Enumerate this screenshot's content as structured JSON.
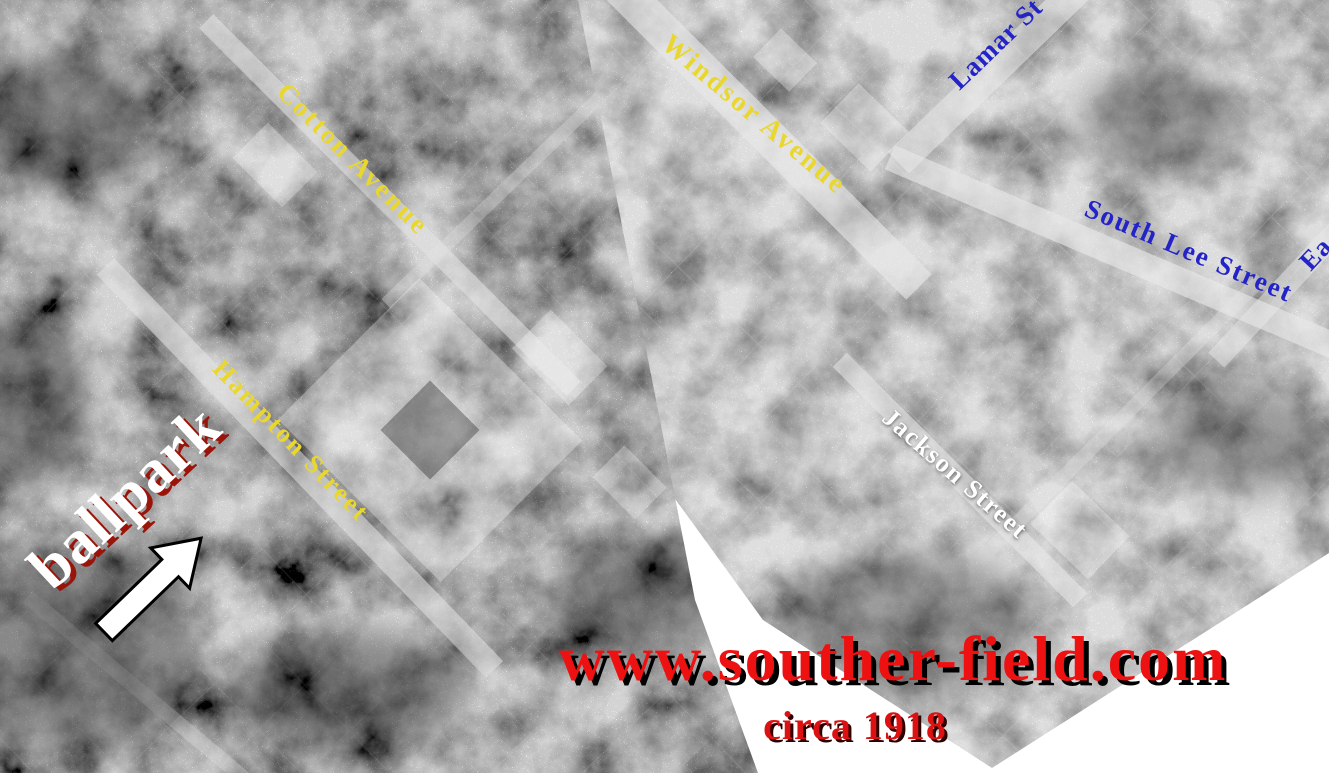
{
  "colors": {
    "street_label_yellow": "#e9d72e",
    "street_label_blue": "#2323c8",
    "street_label_white": "#ffffff",
    "ballpark_text": "#ffffff",
    "ballpark_shadow_red": "#9b1409",
    "website_red": "#ee1111",
    "caption_red": "#dd1111",
    "shadow_black": "#000000",
    "arrow_fill": "#ffffff",
    "arrow_outline": "#000000"
  },
  "street_labels": [
    {
      "id": "cotton-avenue",
      "text": "Cotton Avenue",
      "color_key": "street_label_yellow"
    },
    {
      "id": "windsor-avenue",
      "text": "Windsor Avenue",
      "color_key": "street_label_yellow"
    },
    {
      "id": "hampton-street",
      "text": "Hampton Street",
      "color_key": "street_label_yellow"
    },
    {
      "id": "lamar-street",
      "text": "Lamar St",
      "color_key": "street_label_blue"
    },
    {
      "id": "south-lee-street",
      "text": "South Lee Street",
      "color_key": "street_label_blue"
    },
    {
      "id": "east-street-partial",
      "text": "Ea",
      "color_key": "street_label_blue"
    },
    {
      "id": "jackson-street",
      "text": "Jackson Street",
      "color_key": "street_label_white"
    }
  ],
  "annotations": {
    "ballpark_label": "ballpark",
    "website": "www.souther-field.com",
    "caption": "circa 1918"
  },
  "icons": {
    "ballpark_arrow": "arrow-pointing-upper-right"
  }
}
